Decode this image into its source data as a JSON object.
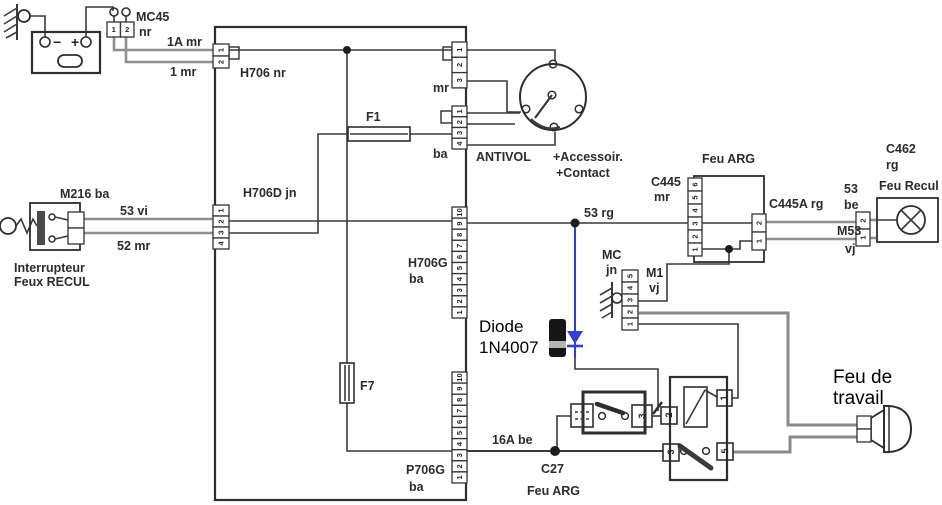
{
  "power": {
    "mc45": "MC45",
    "mc45_sub": "nr",
    "battery_minus": "−",
    "battery_plus": "+",
    "wire_top": "1A mr",
    "wire_bottom": "1 mr",
    "h706": "H706 nr"
  },
  "central_box": {
    "h706d": "H706D  jn",
    "f1": "F1",
    "f7": "F7",
    "h706g": "H706G",
    "h706g_sub": "ba",
    "p706g": "P706G",
    "p706g_sub": "ba"
  },
  "antivol": {
    "mr": "mr",
    "ba": "ba",
    "title": "ANTIVOL",
    "subtitle1": "+Accessoir.",
    "subtitle2": "+Contact"
  },
  "reverse_switch": {
    "title": "M216 ba",
    "wire_53": "53 vi",
    "wire_52": "52 mr",
    "caption1": "Interrupteur",
    "caption2": "Feux RECUL"
  },
  "wires": {
    "w53rg": "53 rg",
    "w16a": "16A be"
  },
  "c27": {
    "name": "C27",
    "sub": "Feu ARG"
  },
  "feu_arg": {
    "title": "Feu ARG",
    "c445": "C445",
    "c445_sub": "mr",
    "c445a": "C445A rg"
  },
  "feu_recul": {
    "c462": "C462",
    "c462_sub": "rg",
    "title": "Feu Recul",
    "wire_be_1": "53",
    "wire_be_2": "be",
    "wire_vj_1": "M53",
    "wire_vj_2": "vj"
  },
  "ground_mc": {
    "mc": "MC",
    "jn": "jn",
    "m1": "M1",
    "vj": "vj"
  },
  "annotations": {
    "diode_line1": "Diode",
    "diode_line2": "1N4007",
    "worklight_line1": "Feu de",
    "worklight_line2": "travail"
  },
  "colors": {
    "diode_wire": "#3340cc",
    "ink": "#3a3a3a"
  },
  "pins": {
    "mc45": [
      "1",
      "2"
    ],
    "h706": [
      "1",
      "2"
    ],
    "antivol_mr": [
      "1",
      "2",
      "3"
    ],
    "antivol_ba": [
      "1",
      "2",
      "3",
      "4"
    ],
    "h706d": [
      "1",
      "2",
      "3",
      "4"
    ],
    "h706g": [
      "10",
      "9",
      "8",
      "7",
      "6",
      "5",
      "4",
      "3",
      "2",
      "1"
    ],
    "p706g": [
      "10",
      "9",
      "8",
      "7",
      "6",
      "5",
      "4",
      "3",
      "2",
      "1"
    ],
    "c445": [
      "6",
      "5",
      "4",
      "3",
      "2",
      "1"
    ],
    "c445a": [
      "2",
      "1"
    ],
    "m1": [
      "5",
      "4",
      "3",
      "2",
      "1"
    ],
    "c462": [
      "2",
      "1"
    ],
    "m216": [
      "",
      ""
    ],
    "worklamp": [
      "",
      ""
    ],
    "relay1_p3": "3",
    "relay2_p2": "2",
    "relay2_p1": "1",
    "relay2_p3": "3",
    "relay2_p5": "5"
  }
}
